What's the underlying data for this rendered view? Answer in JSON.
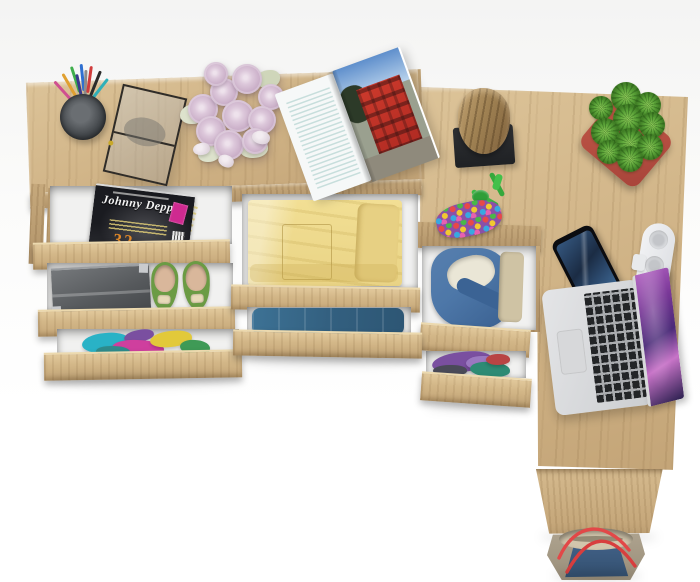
{
  "meta": {
    "domain": "Natural-Image",
    "subject": "Top-down 3D product render of a light-oak L-shaped desk and drawer chest with open drawers, styled with clothing, gadgets and decor on a white floor",
    "background_color": "#f6f6f5"
  },
  "palette": {
    "oak": "#cfb285",
    "oak_dark": "#b2946a",
    "oak_light": "#e2c99c",
    "drawer_interior": "#f1f1f0",
    "pot_red": "#bb5246",
    "plant_green": "#55a038",
    "laptop_silver": "#d5d6d8",
    "laptop_wallpaper_purple": "#8a3a9e",
    "bag_denim_blue": "#3c5e82",
    "bag_khaki": "#a79c88",
    "bag_strap_red": "#e04848"
  },
  "furniture": {
    "left_chest": {
      "label": "chest / desk top with three open drawers"
    },
    "middle_drawers": {
      "label": "two wide open drawers with folded clothes"
    },
    "side_unit": {
      "label": "narrow under-desk drawer unit with two open drawers"
    },
    "right_desk": {
      "label": "desk return surface with vertical side panel"
    }
  },
  "items": {
    "pen_cup": {
      "label": "black cup holding coloured pens and pencils"
    },
    "glass_box": {
      "label": "glass display box with black metal frame"
    },
    "rose_bouquet": {
      "label": "bouquet of pale lilac roses",
      "loose_petals": 3
    },
    "open_magazine": {
      "label": "open magazine showing a red building photo"
    },
    "cover_magazine": {
      "title": "Johnny Depp",
      "issue_digits": "32",
      "badge_color": "#cf2a90"
    },
    "storage_box": {
      "label": "dark grey document box with metal corners"
    },
    "ballet_flats": {
      "label": "green ballet flats with beige bows"
    },
    "bright_clothes": {
      "label": "pile of brightly coloured folded clothes"
    },
    "yellow_shirt": {
      "label": "folded pale-yellow shirt with chest pocket"
    },
    "jeans": {
      "label": "folded blue jeans"
    },
    "denim_jacket": {
      "label": "denim jacket with cream lining"
    },
    "purple_pile": {
      "label": "purple, teal and red folded clothes"
    },
    "stump": {
      "label": "wooden stump decor on a black stand"
    },
    "bead_keychain": {
      "label": "multicolour bead pouch with green cord"
    },
    "succulent": {
      "label": "green succulent in a red square pot"
    },
    "smartphone": {
      "label": "smartphone with dark blue screen"
    },
    "charger": {
      "label": "white charging dock with three round ports"
    },
    "laptop": {
      "label": "silver laptop, open, purple galaxy wallpaper"
    },
    "tote_bag": {
      "label": "denim and khaki tote bag with red rope handles"
    }
  }
}
